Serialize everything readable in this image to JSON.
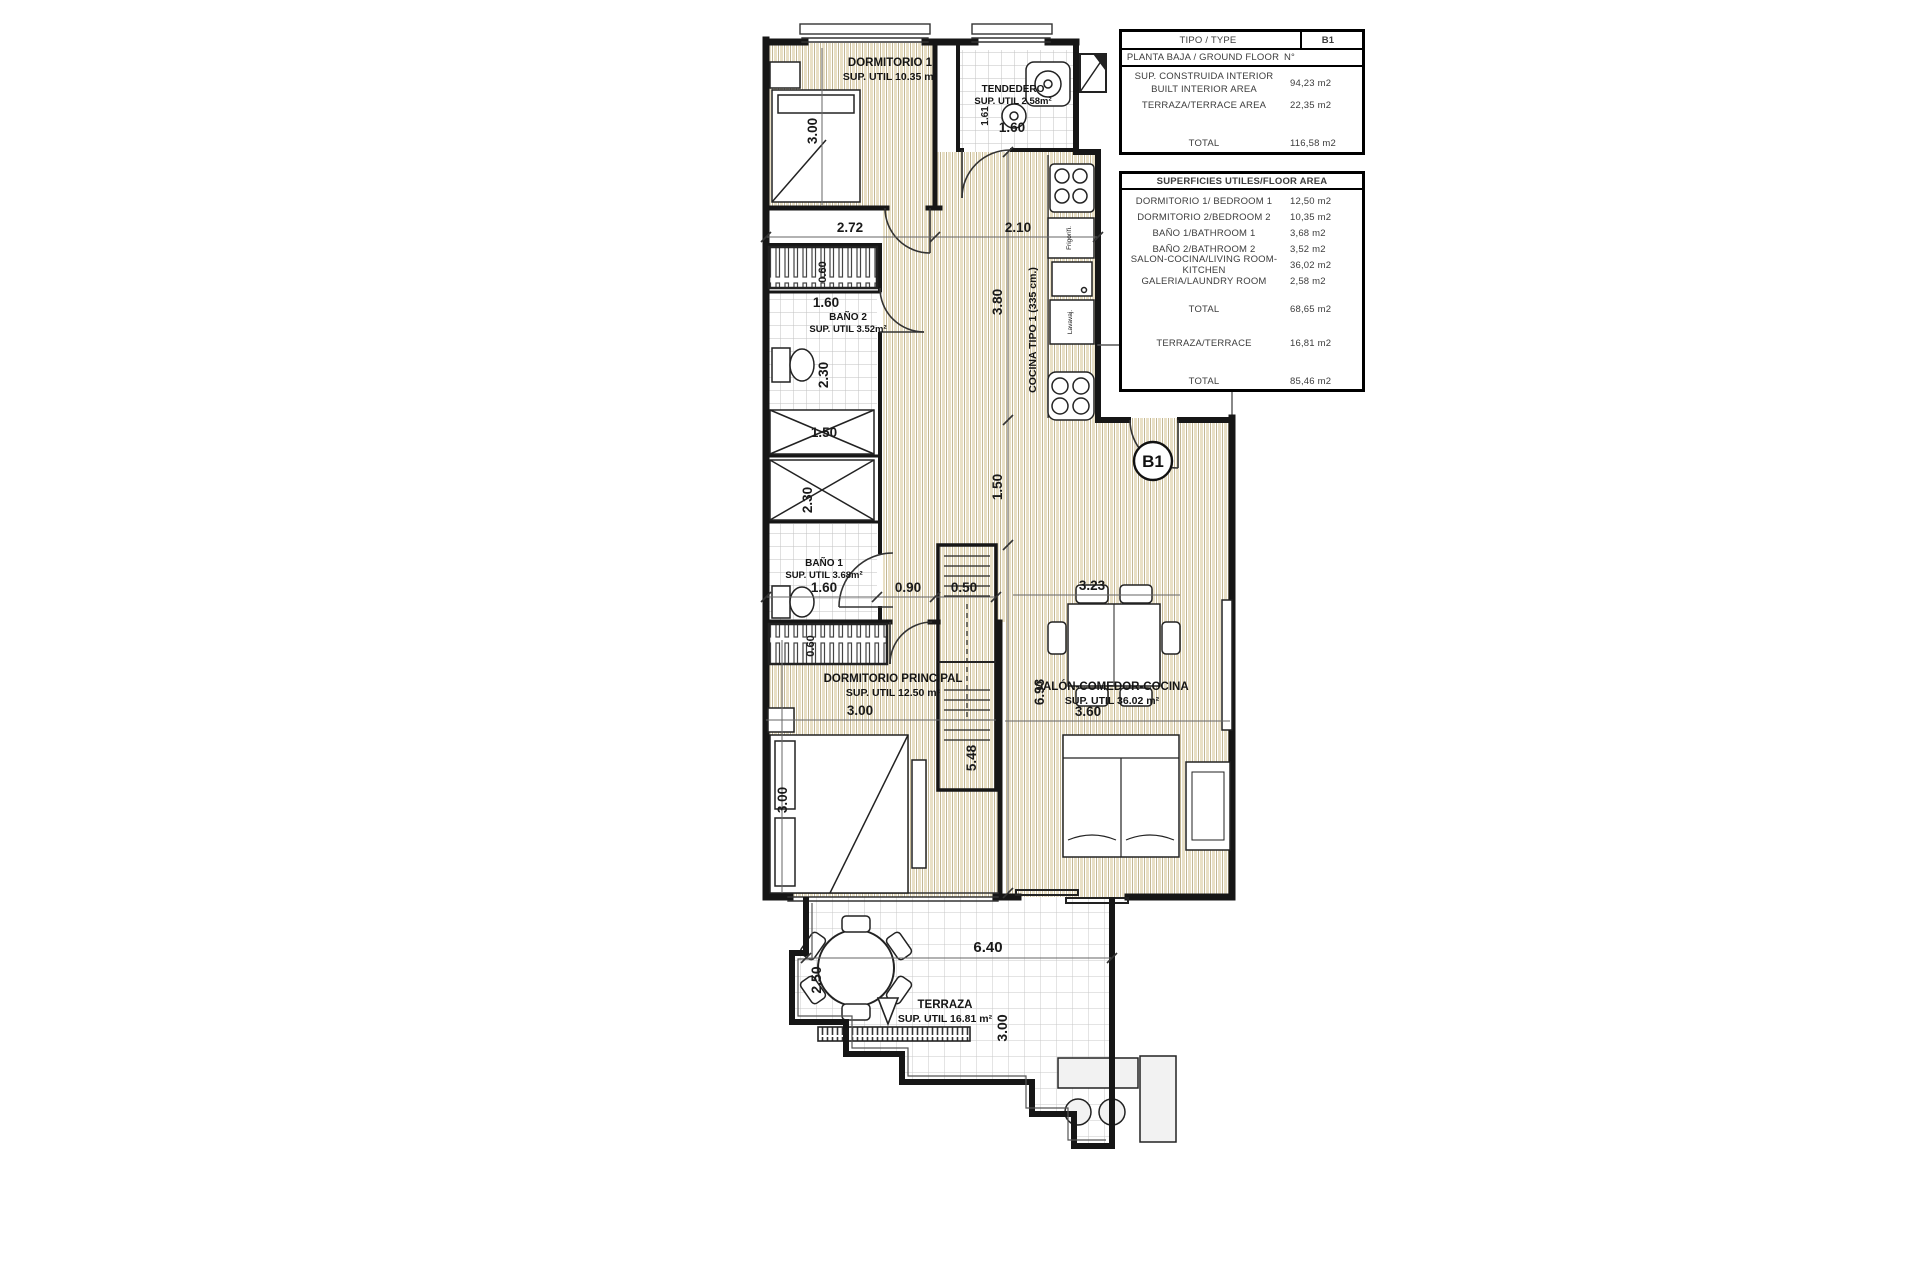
{
  "plan": {
    "badge": "B1",
    "rooms": {
      "dormitorio1": {
        "name": "DORMITORIO 1",
        "area": "SUP. UTIL 10.35 m²"
      },
      "tendedero": {
        "name": "TENDEDERO",
        "area": "SUP. UTIL 2.58m²"
      },
      "bano2": {
        "name": "BAÑO 2",
        "area": "SUP. UTIL 3.52m²"
      },
      "bano1": {
        "name": "BAÑO 1",
        "area": "SUP. UTIL 3.68m²"
      },
      "dormitorioPrincipal": {
        "name": "DORMITORIO PRINCIPAL",
        "area": "SUP. UTIL 12.50 m²"
      },
      "salon": {
        "name": "SALÓN-COMEDOR-COCINA",
        "area": "SUP. UTIL 36.02 m²"
      },
      "cocina": {
        "name": "COCINA TIPO 1 (335 cm.)"
      },
      "terraza": {
        "name": "TERRAZA",
        "area": "SUP. UTIL 16.81 m²"
      }
    },
    "appliances": {
      "fridge": "Frigorífi.",
      "dishwasher": "Lavavaj."
    },
    "dims": {
      "top272": "2.72",
      "top210": "2.10",
      "tend160": "1.60",
      "tend161": "1.61",
      "dorm1v300": "3.00",
      "closetA060": "0.60",
      "bano2_160": "1.60",
      "bano2_230": "2.30",
      "shower150": "1.50",
      "bano1_230": "2.30",
      "bano1_160": "1.60",
      "closetB060": "0.60",
      "mid090": "0.90",
      "mid050": "0.50",
      "kitchen380": "3.80",
      "pass150": "1.50",
      "salon693": "6.93",
      "salon548": "5.48",
      "dining323": "3.23",
      "salon360": "3.60",
      "dp300h": "3.00",
      "dp300v": "3.00",
      "terr640": "6.40",
      "terr250": "2.50",
      "terr300": "3.00"
    }
  },
  "tables": {
    "resumen": {
      "tipo": {
        "label": "TIPO / TYPE",
        "value": "B1"
      },
      "planta": {
        "label": "PLANTA BAJA / GROUND FLOOR",
        "value": "N°"
      },
      "construida": {
        "label1": "SUP. CONSTRUIDA INTERIOR",
        "label2": "BUILT INTERIOR AREA",
        "value": "94,23 m2"
      },
      "terraza": {
        "label": "TERRAZA/TERRACE AREA",
        "value": "22,35 m2"
      },
      "total": {
        "label": "TOTAL",
        "value": "116,58 m2"
      }
    },
    "superficies": {
      "header": "SUPERFICIES UTILES/FLOOR AREA",
      "rows": [
        {
          "label": "DORMITORIO 1/ BEDROOM 1",
          "value": "12,50 m2"
        },
        {
          "label": "DORMITORIO 2/BEDROOM 2",
          "value": "10,35 m2"
        },
        {
          "label": "BAÑO 1/BATHROOM 1",
          "value": "3,68 m2"
        },
        {
          "label": "BAÑO 2/BATHROOM 2",
          "value": "3,52 m2"
        },
        {
          "label": "SALON-COCINA/LIVING ROOM-KITCHEN",
          "value": "36,02 m2"
        },
        {
          "label": "GALERIA/LAUNDRY ROOM",
          "value": "2,58 m2"
        }
      ],
      "total1": {
        "label": "TOTAL",
        "value": "68,65 m2"
      },
      "terraza": {
        "label": "TERRAZA/TERRACE",
        "value": "16,81 m2"
      },
      "total2": {
        "label": "TOTAL",
        "value": "85,46 m2"
      }
    }
  }
}
